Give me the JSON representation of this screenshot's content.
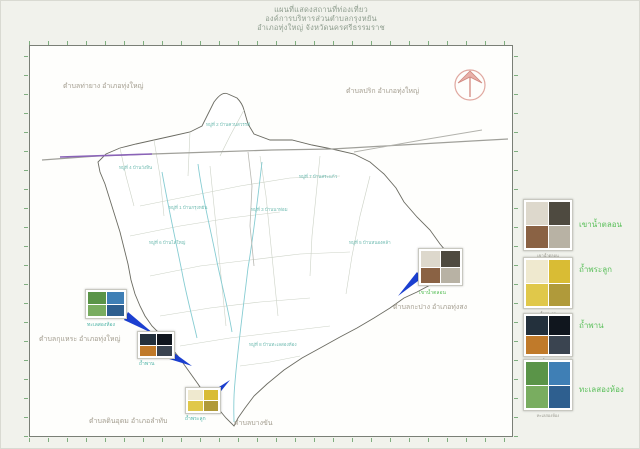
{
  "title": {
    "line1": "แผนที่แสดงสถานที่ท่องเที่ยว",
    "line2": "องค์การบริหารส่วนตำบลกรุงหยัน",
    "line3": "อำเภอทุ่งใหญ่  จังหวัดนครศรีธรรมราช"
  },
  "map": {
    "edge_labels": [
      {
        "text": "ตำบลท่ายาง อำเภอทุ่งใหญ่"
      },
      {
        "text": "ตำบลปริก อำเภอทุ่งใหญ่"
      },
      {
        "text": "ตำบลกุแหระ อำเภอทุ่งใหญ่"
      },
      {
        "text": "ตำบลกะปาง อำเภอทุ่งสง"
      },
      {
        "text": "ตำบลดินอุดม อำเภอลำทับ"
      },
      {
        "text": "ตำบลบางขัน"
      }
    ],
    "place_labels": [
      {
        "text": "หมู่ที่ 2 บ้านควนสวรรค์"
      },
      {
        "text": "หมู่ที่ 4 บ้านวังหิน"
      },
      {
        "text": "หมู่ที่ 1 บ้านกรุงหยัน"
      },
      {
        "text": "หมู่ที่ 6 บ้านไสใหญ่"
      },
      {
        "text": "หมู่ที่ 3 บ้านนาท่อม"
      },
      {
        "text": "หมู่ที่ 5 บ้านหนองคล้า"
      },
      {
        "text": "หมู่ที่ 7 บ้านสระแก้ว"
      },
      {
        "text": "หมู่ที่ 8 บ้านทะเลสองห้อง"
      }
    ],
    "colors": {
      "tick_green": "#7fae7f",
      "edge_label_gray": "#a39d8f",
      "legend_green": "#5cc05c",
      "arrow_blue": "#1b3fd0",
      "road_purple": "#8a63b8",
      "stream_teal": "#86ccd2"
    }
  },
  "attractions": [
    {
      "name": "เขาน้ำตลอน"
    },
    {
      "name": "ถ้ำพระลูก"
    },
    {
      "name": "ถ้ำพาน"
    },
    {
      "name": "ทะเลสองห้อง"
    }
  ],
  "photos": {
    "brown": {
      "colors": [
        "#ddd8cc",
        "#4e4a40",
        "#8a6244",
        "#b8b2a4"
      ]
    },
    "yellow": {
      "colors": [
        "#efe9cf",
        "#d9bc34",
        "#e0c84a",
        "#b09a3a"
      ]
    },
    "dark": {
      "colors": [
        "#23303c",
        "#10161e",
        "#c07a2a",
        "#3a4450"
      ]
    },
    "lake": {
      "colors": [
        "#5a9448",
        "#3f7fb5",
        "#79ad60",
        "#2e5f8f"
      ]
    }
  }
}
